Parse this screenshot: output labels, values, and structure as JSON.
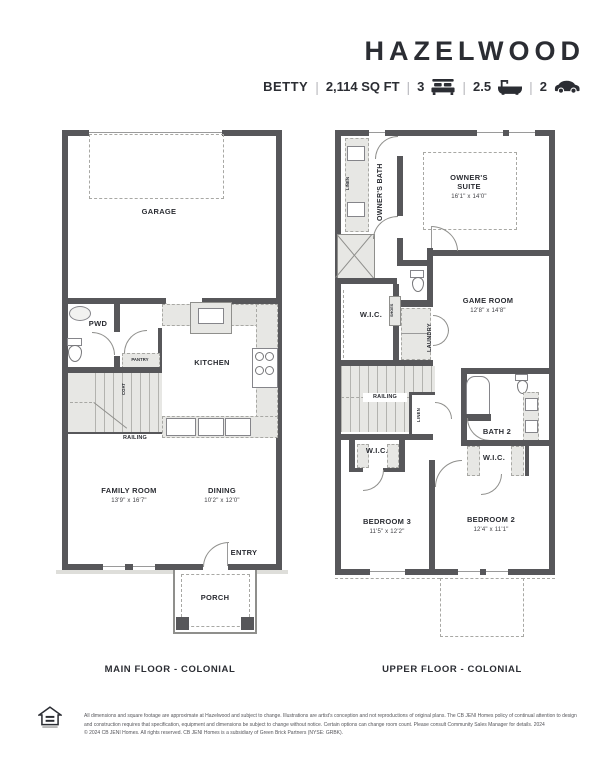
{
  "header": {
    "plan_name": "HAZELWOOD",
    "elevation": "BETTY",
    "sqft": "2,114 SQ FT",
    "beds": "3",
    "baths": "2.5",
    "garage": "2",
    "separator": "|"
  },
  "icons": {
    "beds": "bed-icon",
    "baths": "bath-icon",
    "garage": "car-icon",
    "logo": "equal-housing-logo"
  },
  "main_floor": {
    "caption": "MAIN FLOOR - COLONIAL",
    "garage": "GARAGE",
    "pwd": "PWD",
    "pantry": "PANTRY",
    "coat": "COAT",
    "kitchen": "KITCHEN",
    "railing": "RAILING",
    "family_room": "FAMILY ROOM",
    "family_room_dims": "13'9\" x 16'7\"",
    "dining": "DINING",
    "dining_dims": "10'2\" x 12'0\"",
    "entry": "ENTRY",
    "porch": "PORCH"
  },
  "upper_floor": {
    "caption": "UPPER FLOOR - COLONIAL",
    "linen_top": "LINEN",
    "owners_bath": "OWNER'S BATH",
    "owners_suite": "OWNER'S SUITE",
    "owners_suite_dims": "16'1\" x 14'0\"",
    "wic_owner": "W.I.C.",
    "shoes": "SHOES",
    "laundry": "LAUNDRY",
    "game_room": "GAME ROOM",
    "game_room_dims": "12'8\" x 14'8\"",
    "railing": "RAILING",
    "linen_mid": "LINEN",
    "bath2": "BATH 2",
    "wic_bed3": "W.I.C.",
    "wic_bed2": "W.I.C.",
    "bedroom3": "BEDROOM 3",
    "bedroom3_dims": "11'5\" x 12'2\"",
    "bedroom2": "BEDROOM 2",
    "bedroom2_dims": "12'4\" x 11'1\""
  },
  "footer": {
    "line1": "All dimensions and square footage are approximate at Hazelwood and subject to change. Illustrations are artist's conception and not reproductions of original plans. The CB JENI Homes policy of continual attention to design",
    "line2": "and construction requires that specification, equipment and dimensions be subject to change without notice. Certain options can change room count. Please consult Community Sales Manager for details. 2024",
    "line3": "© 2024 CB JENI Homes. All rights reserved. CB JENI Homes is a subsidiary of Green Brick Partners (NYSE: GRBK)."
  },
  "colors": {
    "wall": "#57575a",
    "light_fill": "#e7e7e4",
    "text": "#2b2d33",
    "dash": "#a8a8a4"
  }
}
